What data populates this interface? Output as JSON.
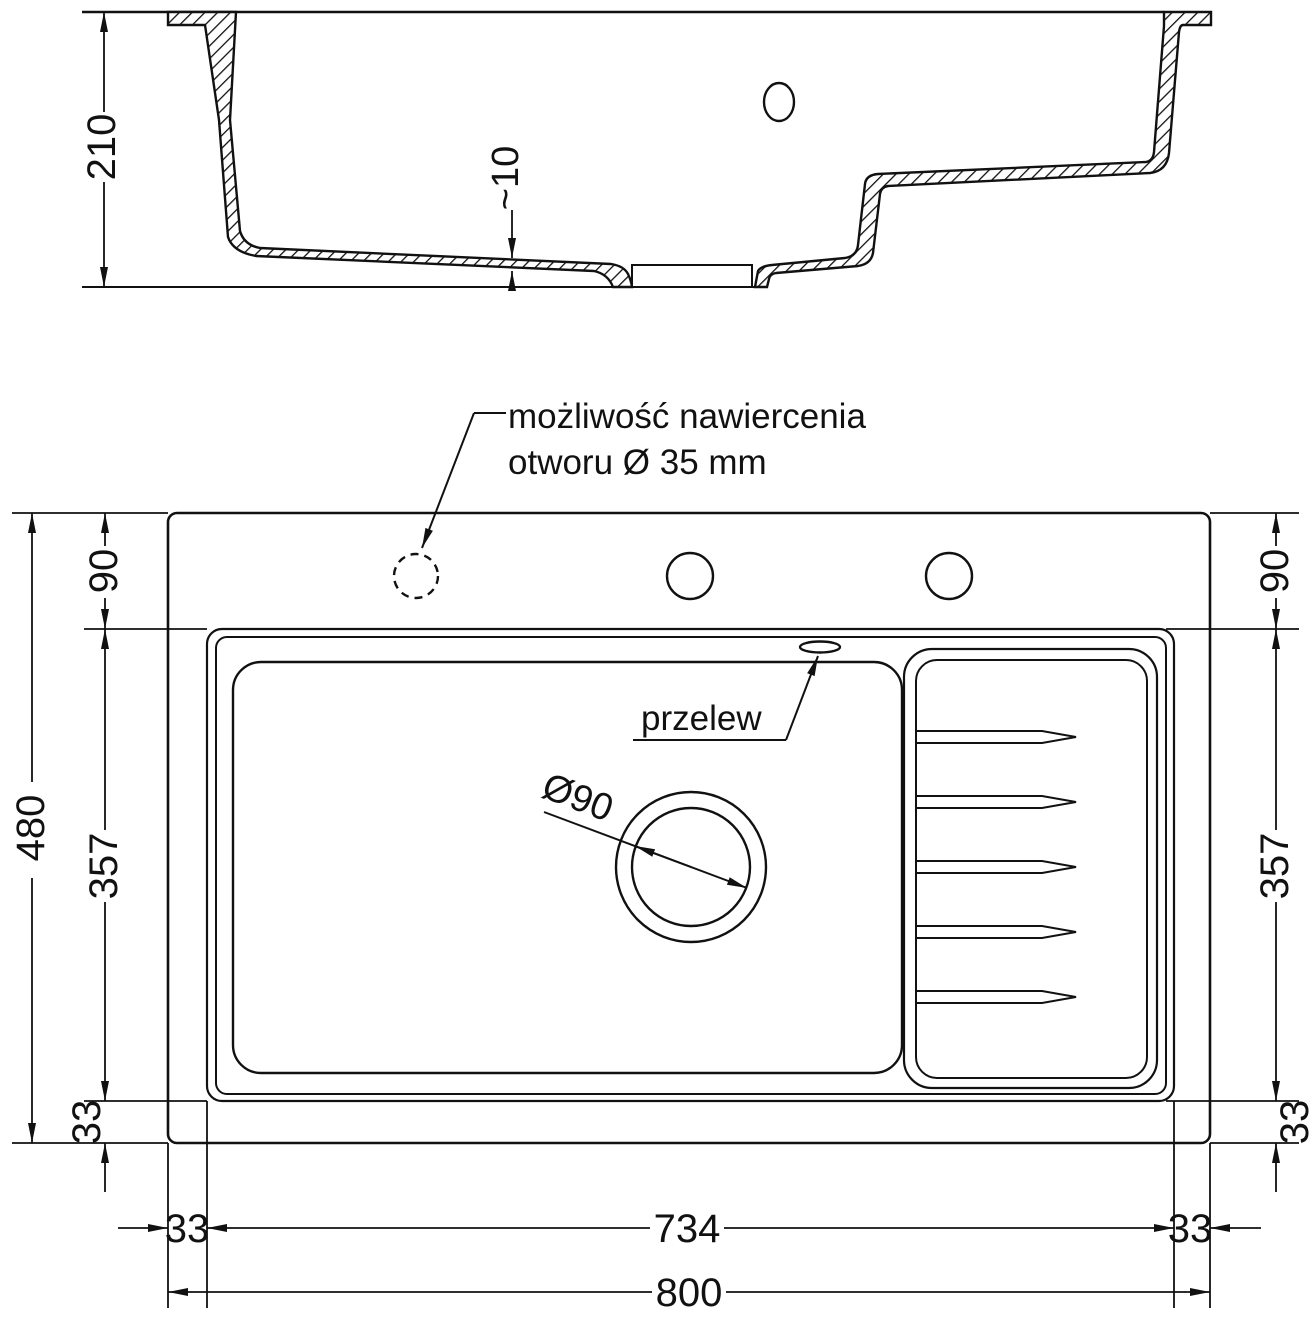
{
  "drawing": {
    "type": "technical dimension drawing — kitchen sink, section and plan view",
    "section_view": {
      "overall_height": "210",
      "floor_thickness": "~10"
    },
    "plan_view": {
      "callout": {
        "line1": "możliwość nawiercenia",
        "line2": "otworu Ø 35 mm"
      },
      "overflow_label": "przelew",
      "drain_diameter_label": "Ø90",
      "left_dims": {
        "overall": "480",
        "top": "90",
        "middle": "357",
        "bottom": "33"
      },
      "right_dims": {
        "top": "90",
        "middle": "357",
        "bottom": "33"
      },
      "bottom_dims": {
        "left_margin": "33",
        "inner_width": "734",
        "right_margin": "33",
        "overall_width": "800"
      }
    },
    "colors": {
      "line": "#111111",
      "background": "#ffffff"
    }
  }
}
